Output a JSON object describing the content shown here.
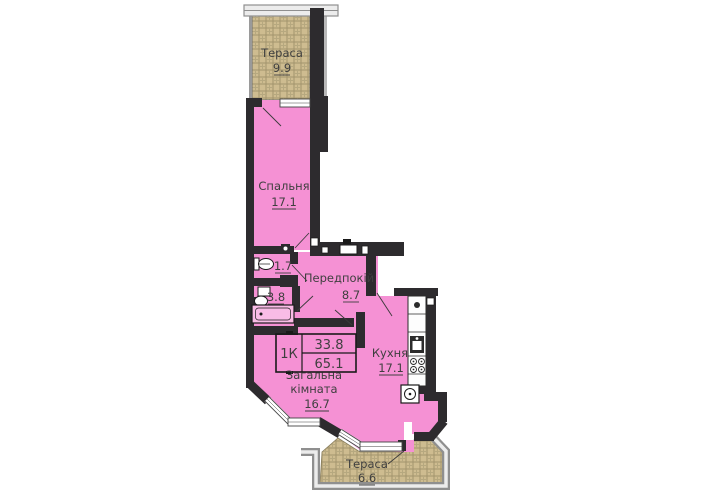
{
  "rooms": {
    "terrace_top": {
      "label": "Тераса",
      "area": "9.9"
    },
    "bedroom": {
      "label": "Спальня",
      "area": "17.1"
    },
    "wc": {
      "area": "1.7"
    },
    "bathroom": {
      "area": "3.8"
    },
    "hallway": {
      "label": "Передпокій",
      "area": "8.7"
    },
    "living_room": {
      "label_line1": "Загальна",
      "label_line2": "кімната",
      "area": "16.7"
    },
    "kitchen": {
      "label": "Кухня",
      "area": "17.1"
    },
    "terrace_bottom": {
      "label": "Тераса",
      "area": "6.6"
    }
  },
  "stamp": {
    "type_label": "1К",
    "living_area": "33.8",
    "total_area": "65.1"
  },
  "colors": {
    "room_fill": "#f591d4",
    "wall": "#2d2b2e",
    "terrace_fill": "#cebc90",
    "railing": "#8f8f8f",
    "window": "#ffffff",
    "label_text": "#3f3f3f"
  }
}
